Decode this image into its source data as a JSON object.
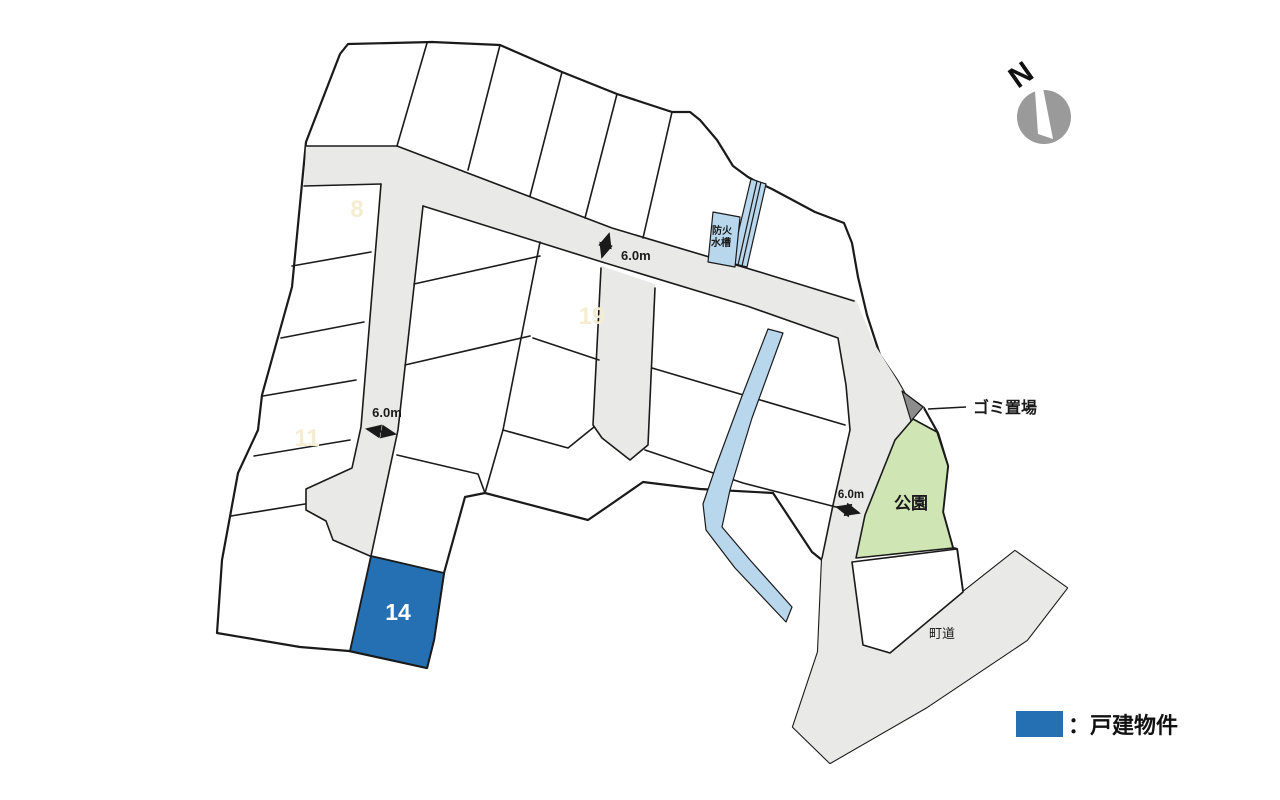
{
  "colors": {
    "road": "#e9e9e7",
    "outline": "#1a1a1a",
    "highlight_blue": "#2470b3",
    "water_blue": "#b9d7ec",
    "park_green": "#cfe5b4",
    "garbage_gray": "#8c8c8c",
    "faint_label": "#f5edd2",
    "compass_gray": "#9a9a9a"
  },
  "lots": {
    "lot8": "8",
    "lot11": "11",
    "lot19": "19",
    "lot14": "14"
  },
  "features": {
    "fire_tank_line1": "防火",
    "fire_tank_line2": "水槽",
    "park": "公園",
    "garbage": "ゴミ置場",
    "town_road": "町道"
  },
  "annotations": {
    "road_width_main": "6.0m",
    "road_width_left": "6.0m",
    "road_width_park": "6.0m"
  },
  "compass": {
    "label": "N"
  },
  "legend": {
    "label": "：戸建物件"
  }
}
